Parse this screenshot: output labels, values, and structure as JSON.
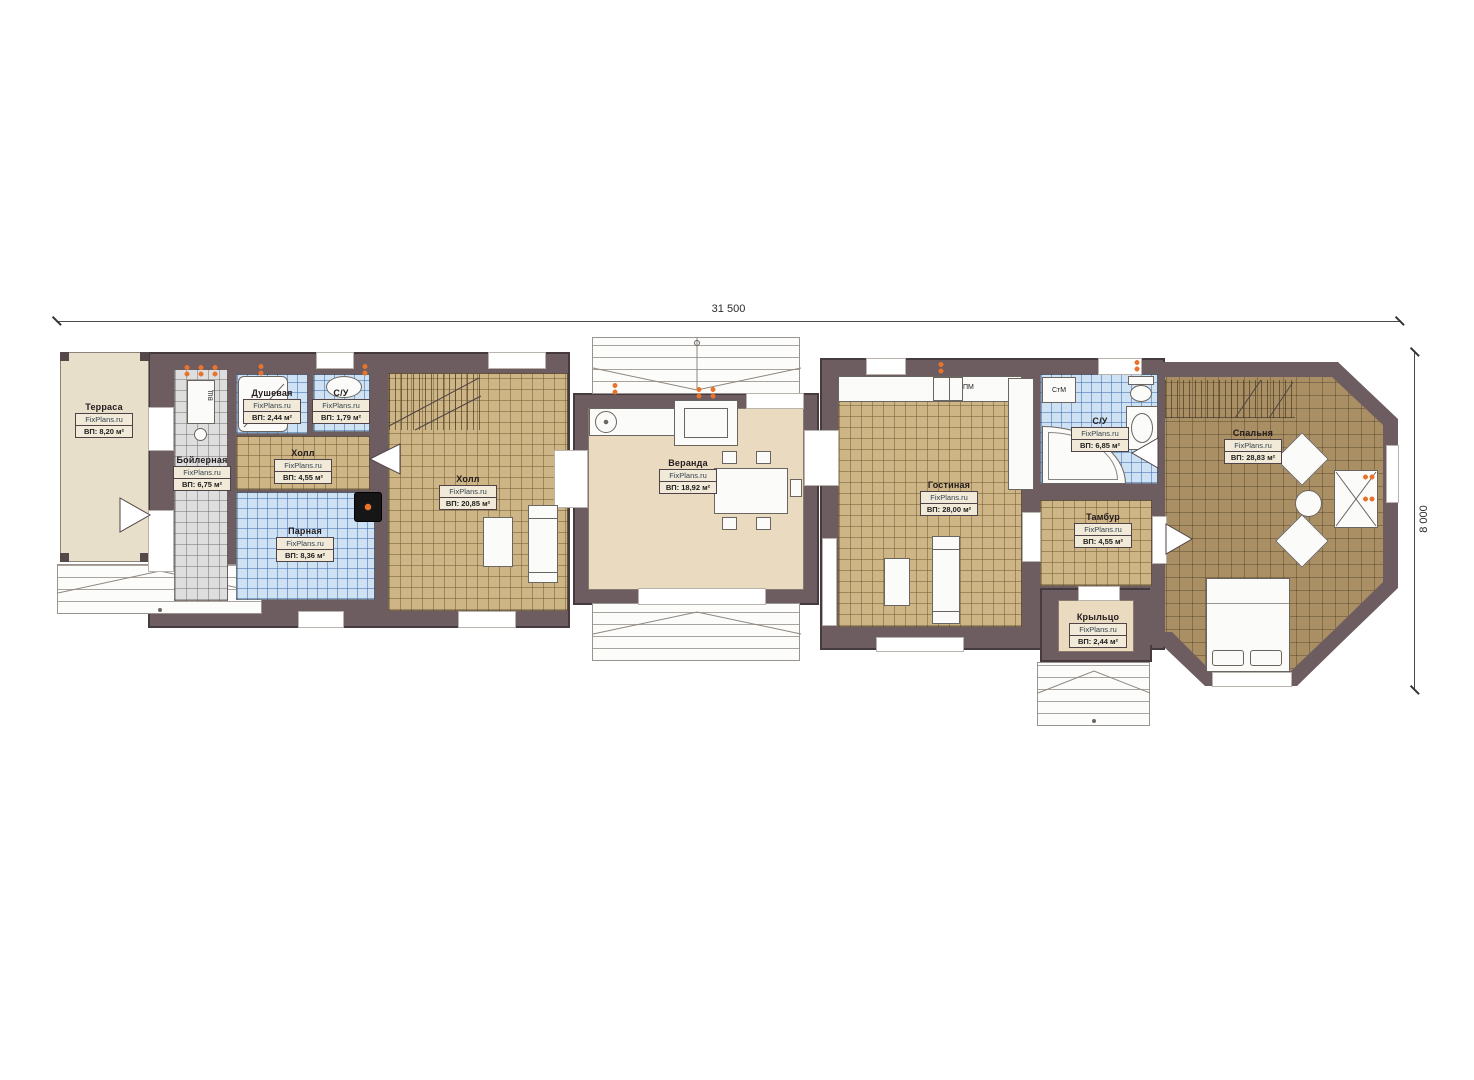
{
  "dimensions": {
    "overall_width": "31 500",
    "overall_height": "8 000"
  },
  "brand": "FixPlans.ru",
  "rooms": {
    "terrace": {
      "name": "Терраса",
      "brand": "FixPlans.ru",
      "area": "ВП: 8,20 м²"
    },
    "boiler": {
      "name": "Бойлерная",
      "brand": "FixPlans.ru",
      "area": "ВП: 6,75 м²"
    },
    "shower": {
      "name": "Душевая",
      "brand": "FixPlans.ru",
      "area": "ВП: 2,44 м²"
    },
    "wc_sauna": {
      "name": "С/У",
      "brand": "FixPlans.ru",
      "area": "ВП: 1,79 м²"
    },
    "hall_sauna": {
      "name": "Холл",
      "brand": "FixPlans.ru",
      "area": "ВП: 4,55 м²"
    },
    "steam": {
      "name": "Парная",
      "brand": "FixPlans.ru",
      "area": "ВП: 8,36 м²"
    },
    "hall_main": {
      "name": "Холл",
      "brand": "FixPlans.ru",
      "area": "ВП: 20,85 м²"
    },
    "veranda": {
      "name": "Веранда",
      "brand": "FixPlans.ru",
      "area": "ВП: 18,92 м²"
    },
    "living": {
      "name": "Гостиная",
      "brand": "FixPlans.ru",
      "area": "ВП: 28,00 м²"
    },
    "wc_main": {
      "name": "С/У",
      "brand": "FixPlans.ru",
      "area": "ВП: 6,85 м²"
    },
    "tambour": {
      "name": "Тамбур",
      "brand": "FixPlans.ru",
      "area": "ВП: 4,55 м²"
    },
    "porch": {
      "name": "Крыльцо",
      "brand": "FixPlans.ru",
      "area": "ВП: 2,44 м²"
    },
    "bedroom": {
      "name": "Спальня",
      "brand": "FixPlans.ru",
      "area": "ВП: 28,83 м²"
    }
  },
  "appliances": {
    "dishwasher": "ПМ",
    "washing_machine": "СтМ",
    "water_heater": "ВЩ"
  },
  "colors": {
    "wall": "#6e5d60",
    "tile_tan": "#cdb586",
    "tile_blue": "#cfe2f4",
    "tile_gray": "#dedede",
    "floor_olive": "#a98f63",
    "floor_beige": "#eadbc0",
    "accent_orange": "#e8742c"
  }
}
